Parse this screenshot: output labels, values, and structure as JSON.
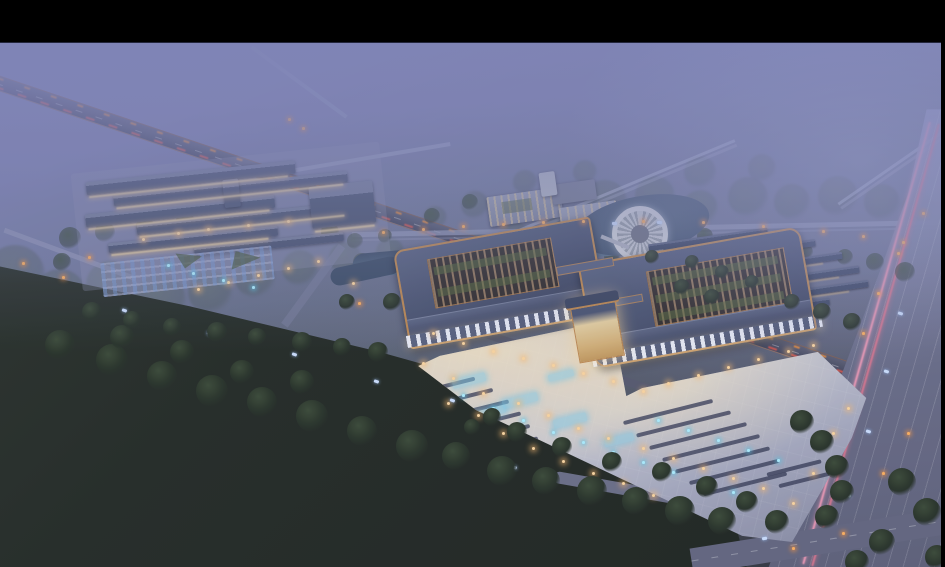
{
  "meta": {
    "description": "Dusk aerial architectural rendering: a large campus with twin Chinese-style pavilion halls around garden courtyards, a lit plaza with bus/parking strips, a secondary exhibition complex with parking lot, a pond with circular island pavilion, rows of long outbuildings, highways with light trails, misty fields and dark tree-covered land",
    "canvas_width": 945,
    "canvas_height": 567
  },
  "palette": {
    "letterbox": "#000000",
    "mist_top": "#8186b8",
    "haze_green": "#4e5b55",
    "field_dark": "#1d231c",
    "field_edge": "#2c342b",
    "road_light": "#9aa0bf",
    "road_mid": "#6b7088",
    "road_dark": "#454960",
    "streak_orange": "#e08a3c",
    "streak_red": "#d4554a",
    "streak_pink": "#ef9ab5",
    "plaza_light": "#c9cbd4",
    "plaza_warm": "#e8dfc4",
    "roof_slate": "#49536e",
    "roof_dark": "#394159",
    "trim_copper": "#c08a4e",
    "lattice_brown": "#6d5942",
    "garden_green": "#4f5e3a",
    "pond": "#44566e",
    "tree_green": "#2e3b2d",
    "window_warm": "#f5d9a2",
    "glow_cool": "#8fd8ee"
  },
  "scene": {
    "trees_haze": [
      [
        15,
        275,
        30
      ],
      [
        60,
        295,
        26
      ],
      [
        110,
        285,
        24
      ],
      [
        160,
        300,
        26
      ],
      [
        210,
        292,
        22
      ],
      [
        255,
        278,
        20
      ],
      [
        300,
        268,
        18
      ],
      [
        345,
        258,
        16
      ],
      [
        390,
        252,
        14
      ],
      [
        95,
        330,
        22
      ],
      [
        40,
        318,
        20
      ],
      [
        145,
        322,
        18
      ],
      [
        470,
        250,
        20
      ],
      [
        515,
        240,
        18
      ],
      [
        558,
        232,
        16
      ],
      [
        605,
        202,
        22
      ],
      [
        655,
        196,
        20
      ],
      [
        700,
        208,
        18
      ],
      [
        748,
        197,
        20
      ],
      [
        792,
        202,
        18
      ],
      [
        838,
        196,
        20
      ],
      [
        882,
        202,
        18
      ],
      [
        918,
        208,
        16
      ],
      [
        700,
        172,
        16
      ],
      [
        762,
        168,
        14
      ],
      [
        642,
        232,
        14
      ],
      [
        585,
        172,
        12
      ],
      [
        525,
        182,
        12
      ],
      [
        475,
        205,
        14
      ],
      [
        435,
        218,
        12
      ]
    ],
    "trees_mid": [
      [
        70,
        238,
        11
      ],
      [
        105,
        232,
        10
      ],
      [
        145,
        226,
        9
      ],
      [
        185,
        220,
        9
      ],
      [
        330,
        232,
        9
      ],
      [
        362,
        262,
        9
      ],
      [
        400,
        262,
        8
      ],
      [
        432,
        216,
        8
      ],
      [
        470,
        202,
        8
      ],
      [
        612,
        256,
        8
      ],
      [
        355,
        241,
        8
      ],
      [
        385,
        236,
        7
      ],
      [
        705,
        236,
        8
      ],
      [
        735,
        241,
        8
      ],
      [
        765,
        247,
        8
      ],
      [
        805,
        252,
        8
      ],
      [
        845,
        257,
        8
      ],
      [
        875,
        262,
        9
      ],
      [
        905,
        272,
        10
      ],
      [
        62,
        262,
        9
      ]
    ],
    "trees_dark": [
      [
        60,
        345,
        15
      ],
      [
        112,
        360,
        16
      ],
      [
        162,
        376,
        15
      ],
      [
        212,
        391,
        16
      ],
      [
        262,
        402,
        15
      ],
      [
        312,
        416,
        16
      ],
      [
        362,
        431,
        15
      ],
      [
        412,
        446,
        16
      ],
      [
        456,
        456,
        14
      ],
      [
        302,
        382,
        12
      ],
      [
        242,
        372,
        12
      ],
      [
        182,
        352,
        12
      ],
      [
        122,
        337,
        12
      ],
      [
        502,
        471,
        15
      ],
      [
        546,
        481,
        14
      ],
      [
        592,
        491,
        15
      ],
      [
        636,
        501,
        14
      ],
      [
        680,
        511,
        15
      ],
      [
        722,
        521,
        14
      ],
      [
        92,
        312,
        10
      ],
      [
        132,
        320,
        9
      ],
      [
        172,
        327,
        9
      ],
      [
        217,
        332,
        10
      ],
      [
        257,
        337,
        9
      ],
      [
        302,
        342,
        10
      ],
      [
        342,
        347,
        9
      ],
      [
        378,
        352,
        10
      ],
      [
        392,
        302,
        9
      ],
      [
        347,
        302,
        8
      ],
      [
        492,
        417,
        9
      ],
      [
        472,
        427,
        8
      ],
      [
        517,
        432,
        10
      ],
      [
        562,
        447,
        10
      ],
      [
        612,
        462,
        10
      ],
      [
        662,
        472,
        10
      ],
      [
        707,
        487,
        11
      ],
      [
        747,
        502,
        11
      ],
      [
        777,
        522,
        12
      ],
      [
        802,
        422,
        12
      ],
      [
        822,
        442,
        12
      ],
      [
        837,
        467,
        12
      ],
      [
        842,
        492,
        12
      ],
      [
        827,
        517,
        12
      ],
      [
        902,
        482,
        14
      ],
      [
        927,
        512,
        14
      ],
      [
        882,
        542,
        13
      ],
      [
        937,
        557,
        12
      ],
      [
        857,
        562,
        12
      ],
      [
        652,
        257,
        7
      ],
      [
        692,
        262,
        7
      ],
      [
        722,
        272,
        7
      ],
      [
        752,
        282,
        7
      ],
      [
        682,
        287,
        8
      ],
      [
        712,
        297,
        8
      ],
      [
        792,
        302,
        8
      ],
      [
        822,
        312,
        9
      ],
      [
        852,
        322,
        9
      ]
    ],
    "warm_lights": [
      [
        432,
        332
      ],
      [
        462,
        342
      ],
      [
        492,
        350
      ],
      [
        522,
        357
      ],
      [
        552,
        364
      ],
      [
        582,
        372
      ],
      [
        612,
        380
      ],
      [
        642,
        390
      ],
      [
        667,
        382
      ],
      [
        697,
        374
      ],
      [
        727,
        366
      ],
      [
        757,
        358
      ],
      [
        787,
        350
      ],
      [
        812,
        344
      ],
      [
        422,
        362
      ],
      [
        452,
        377
      ],
      [
        482,
        392
      ],
      [
        517,
        402
      ],
      [
        547,
        414
      ],
      [
        577,
        427
      ],
      [
        607,
        437
      ],
      [
        642,
        447
      ],
      [
        672,
        457
      ],
      [
        702,
        467
      ],
      [
        732,
        477
      ],
      [
        762,
        487
      ],
      [
        502,
        432
      ],
      [
        532,
        447
      ],
      [
        562,
        460
      ],
      [
        592,
        472
      ],
      [
        622,
        482
      ],
      [
        652,
        494
      ],
      [
        447,
        402
      ],
      [
        477,
        414
      ],
      [
        792,
        502
      ],
      [
        812,
        472
      ],
      [
        832,
        432
      ],
      [
        847,
        407
      ],
      [
        177,
        232
      ],
      [
        207,
        228
      ],
      [
        247,
        224
      ],
      [
        287,
        220
      ],
      [
        142,
        238
      ],
      [
        317,
        260
      ],
      [
        287,
        267
      ],
      [
        257,
        274
      ],
      [
        227,
        281
      ],
      [
        197,
        288
      ],
      [
        352,
        282
      ]
    ],
    "cool_lights": [
      [
        462,
        394
      ],
      [
        492,
        407
      ],
      [
        522,
        419
      ],
      [
        552,
        431
      ],
      [
        582,
        441
      ],
      [
        612,
        451
      ],
      [
        642,
        461
      ],
      [
        672,
        471
      ],
      [
        702,
        481
      ],
      [
        732,
        491
      ],
      [
        657,
        419
      ],
      [
        687,
        429
      ],
      [
        717,
        439
      ],
      [
        747,
        449
      ],
      [
        777,
        459
      ],
      [
        192,
        272
      ],
      [
        222,
        279
      ],
      [
        252,
        286
      ],
      [
        167,
        264
      ]
    ],
    "street_lamps": [
      [
        382,
        231
      ],
      [
        422,
        228
      ],
      [
        462,
        225
      ],
      [
        502,
        223
      ],
      [
        542,
        221
      ],
      [
        582,
        220
      ],
      [
        642,
        220
      ],
      [
        702,
        221
      ],
      [
        762,
        225
      ],
      [
        822,
        230
      ],
      [
        862,
        235
      ],
      [
        902,
        241
      ],
      [
        288,
        118
      ],
      [
        302,
        127
      ],
      [
        22,
        262
      ],
      [
        62,
        276
      ],
      [
        88,
        256
      ],
      [
        358,
        302
      ],
      [
        882,
        472
      ],
      [
        907,
        432
      ],
      [
        862,
        332
      ],
      [
        877,
        292
      ],
      [
        897,
        252
      ],
      [
        922,
        212
      ],
      [
        842,
        532
      ],
      [
        792,
        547
      ]
    ],
    "cars": [
      [
        122,
        309,
        19
      ],
      [
        207,
        332,
        19
      ],
      [
        292,
        353,
        19
      ],
      [
        374,
        380,
        19
      ],
      [
        450,
        399,
        19
      ],
      [
        898,
        312,
        16
      ],
      [
        884,
        370,
        16
      ],
      [
        866,
        430,
        16
      ],
      [
        846,
        494,
        16
      ],
      [
        612,
        222,
        -1
      ],
      [
        657,
        221,
        -1
      ],
      [
        762,
        537,
        -9
      ],
      [
        512,
        466,
        17
      ],
      [
        582,
        486,
        17
      ]
    ],
    "left_complex_roofs": [
      [
        14,
        16,
        210,
        13
      ],
      [
        40,
        32,
        235,
        11
      ],
      [
        10,
        48,
        190,
        13
      ],
      [
        60,
        63,
        215,
        11
      ],
      [
        30,
        79,
        170,
        10
      ],
      [
        115,
        92,
        150,
        9
      ],
      [
        150,
        28,
        16,
        28
      ],
      [
        235,
        44,
        64,
        42
      ]
    ],
    "left_complex_lit": [
      [
        16,
        30,
        200
      ],
      [
        42,
        44,
        228
      ],
      [
        12,
        62,
        182
      ],
      [
        62,
        75,
        206
      ],
      [
        32,
        90,
        158
      ],
      [
        237,
        88,
        60
      ]
    ],
    "dorm_rows": [
      [
        648,
        236,
        120
      ],
      [
        658,
        250,
        158
      ],
      [
        668,
        264,
        175
      ],
      [
        680,
        278,
        180
      ],
      [
        694,
        292,
        175
      ],
      [
        710,
        306,
        120
      ]
    ],
    "plaza_strips": [
      [
        398,
        386,
        78
      ],
      [
        410,
        398,
        84
      ],
      [
        422,
        410,
        88
      ],
      [
        434,
        422,
        88
      ],
      [
        447,
        434,
        84
      ],
      [
        459,
        446,
        80
      ],
      [
        622,
        410,
        92
      ],
      [
        635,
        422,
        97
      ],
      [
        648,
        434,
        100
      ],
      [
        661,
        446,
        100
      ],
      [
        674,
        458,
        97
      ],
      [
        688,
        470,
        92
      ],
      [
        702,
        482,
        86
      ],
      [
        766,
        466,
        56
      ],
      [
        778,
        478,
        52
      ]
    ],
    "plaza_glows": [
      [
        452,
        376,
        34,
        9
      ],
      [
        502,
        396,
        36,
        9
      ],
      [
        553,
        416,
        34,
        9
      ],
      [
        604,
        436,
        30,
        8
      ],
      [
        476,
        408,
        30,
        8
      ],
      [
        548,
        372,
        26,
        7
      ]
    ]
  }
}
